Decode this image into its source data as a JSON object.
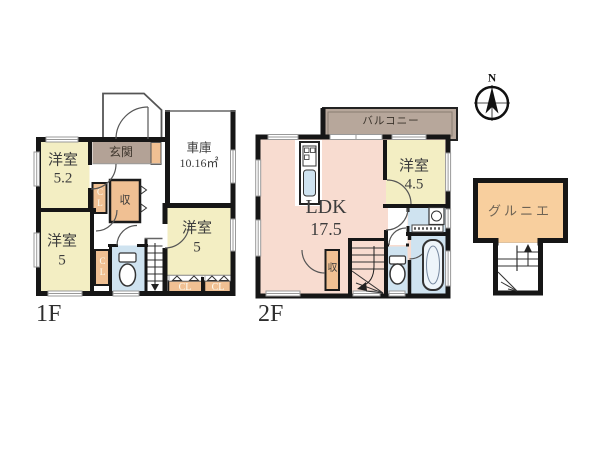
{
  "colors": {
    "wall": "#1a1a1a",
    "room_yellow": "#f3eec3",
    "ldk_pink": "#f8dcd0",
    "closet_orange": "#f0c093",
    "entrance_brown": "#b3a296",
    "balcony_brown": "#b7a79b",
    "attic_orange": "#f8cf9e",
    "water_blue": "#cfe3f0"
  },
  "floor1": {
    "label": "1F",
    "entrance_label": "玄関",
    "garage_name": "車庫",
    "garage_area": "10.16㎡",
    "room_52_name": "洋室",
    "room_52_size": "5.2",
    "room_5bl_name": "洋室",
    "room_5bl_size": "5",
    "room_5br_name": "洋室",
    "room_5br_size": "5",
    "closet_cl_vertical_1": "CL",
    "closet_cl_vertical_2": "CL",
    "closet_storage": "収",
    "closet_cl_a": "CL",
    "closet_cl_b": "CL"
  },
  "floor2": {
    "label": "2F",
    "balcony_label": "バルコニー",
    "ldk_name": "LDK",
    "ldk_size": "17.5",
    "room_45_name": "洋室",
    "room_45_size": "4.5",
    "closet_storage": "収"
  },
  "attic": {
    "label": "グルニエ"
  },
  "compass": {
    "north_label": "N"
  }
}
